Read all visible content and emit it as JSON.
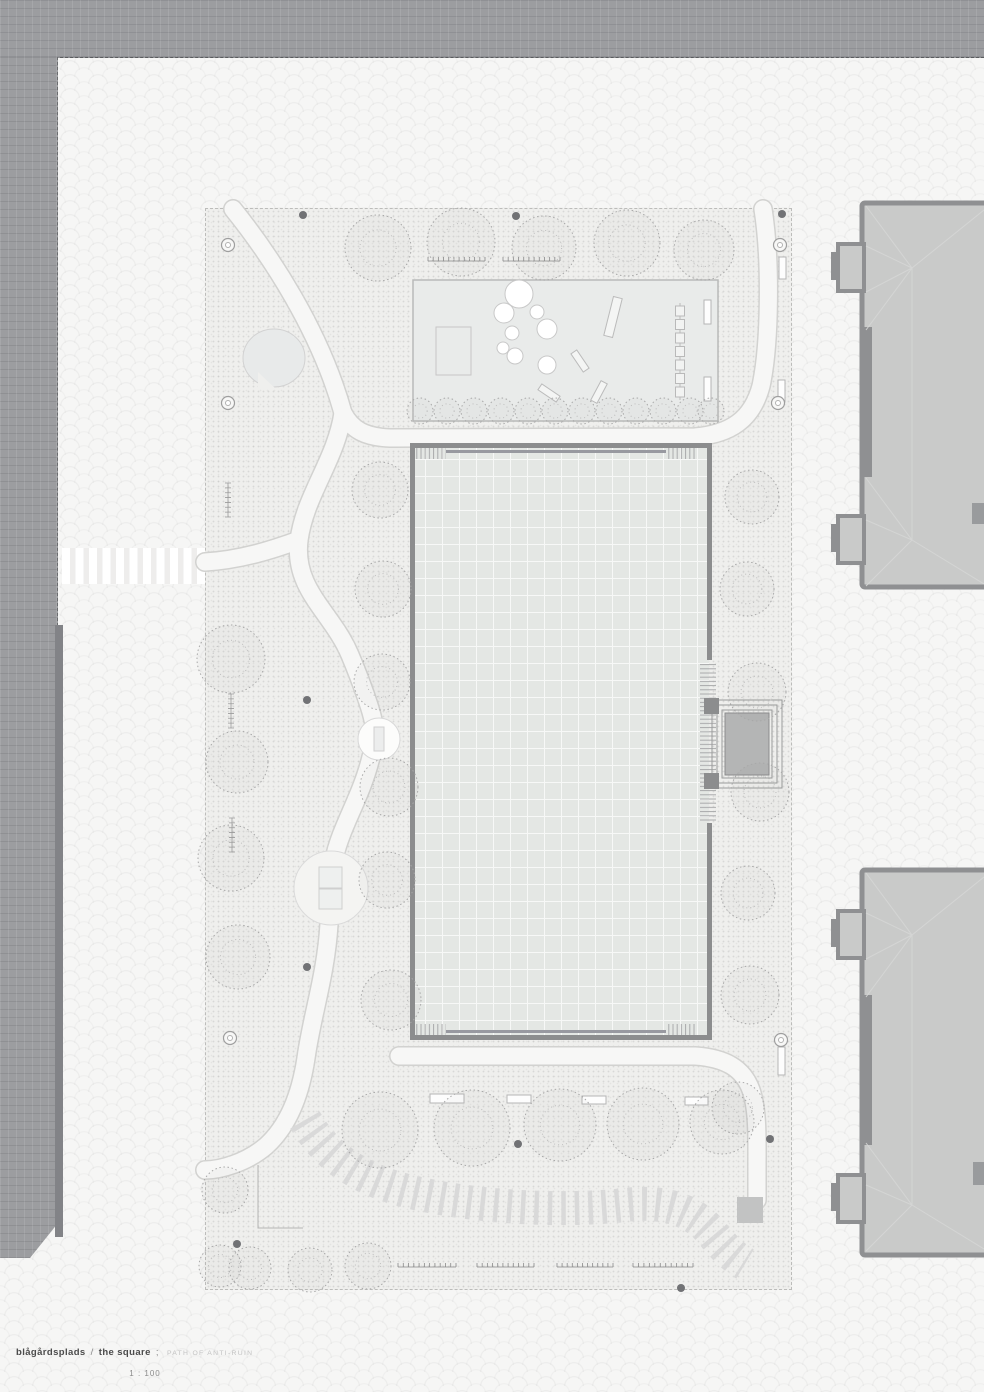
{
  "titleblock": {
    "project": "blågårdsplads",
    "divider": "/",
    "name": "the square",
    "separator": ";",
    "tagline": "PATH OF ANTI-RUIN",
    "scale": "1 : 100"
  },
  "colors": {
    "street": "#9c9da0",
    "sidewalk": "#f6f6f5",
    "park_ground": "#efefed",
    "playground_fill": "#e9ebea",
    "square_fill": "#e4e7e4",
    "square_wall": "#8c8d8e",
    "stage_fill": "#b4b5b5",
    "building_fill": "#c9cac9",
    "building_wall": "#8f9092",
    "path_fill": "#f7f7f6",
    "ribbon_stripe": "#d9d9d9"
  }
}
